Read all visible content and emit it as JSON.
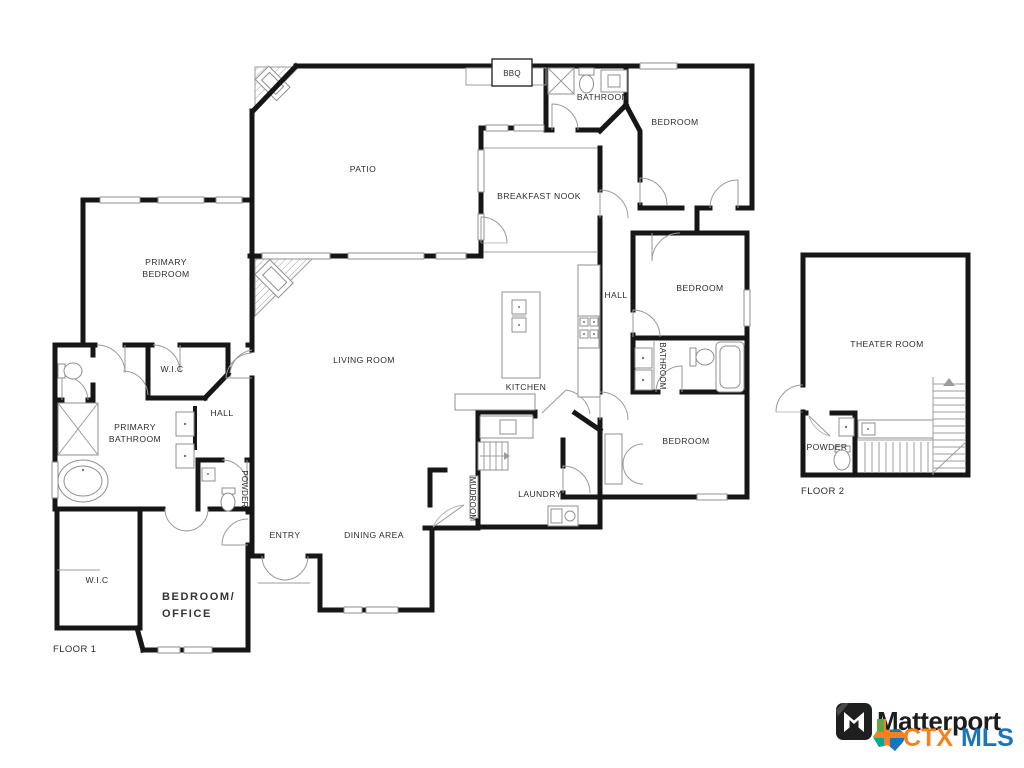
{
  "canvas": {
    "background": "#ffffff"
  },
  "floor1": {
    "floor_label": "FLOOR 1",
    "rooms": {
      "patio": "PATIO",
      "bbq": "BBQ",
      "bathroom_top": "BATHROOM",
      "bedroom_top_right": "BEDROOM",
      "breakfast_nook": "BREAKFAST NOOK",
      "primary_bedroom": [
        "PRIMARY",
        "BEDROOM"
      ],
      "hall_right": "HALL",
      "bedroom_mid_right": "BEDROOM",
      "living_room": "LIVING ROOM",
      "kitchen": "KITCHEN",
      "bathroom_mid": "BATHROOM",
      "wic_primary": "W.I.C",
      "hall_left": "HALL",
      "primary_bathroom": [
        "PRIMARY",
        "BATHROOM"
      ],
      "powder_left": "POWDER",
      "bedroom_bottom_right": "BEDROOM",
      "entry": "ENTRY",
      "dining_area": "DINING AREA",
      "mudroom": "MUDROOM",
      "laundry": "LAUNDRY",
      "wic_bottom_left": "W.I.C",
      "bedroom_office": [
        "BEDROOM/",
        "OFFICE"
      ]
    }
  },
  "floor2": {
    "floor_label": "FLOOR 2",
    "rooms": {
      "theater_room": "THEATER ROOM",
      "powder": "POWDER"
    }
  },
  "branding": {
    "matterport_wordmark": "Matterport",
    "ctx": "CTX",
    "mls": "MLS",
    "colors": {
      "matterport_black": "#1c1c1c",
      "ctx_orange": "#f5821f",
      "mls_blue": "#1b75bc",
      "texas_green": "#61a744",
      "texas_teal": "#00a79d",
      "wall": "#161616"
    }
  }
}
